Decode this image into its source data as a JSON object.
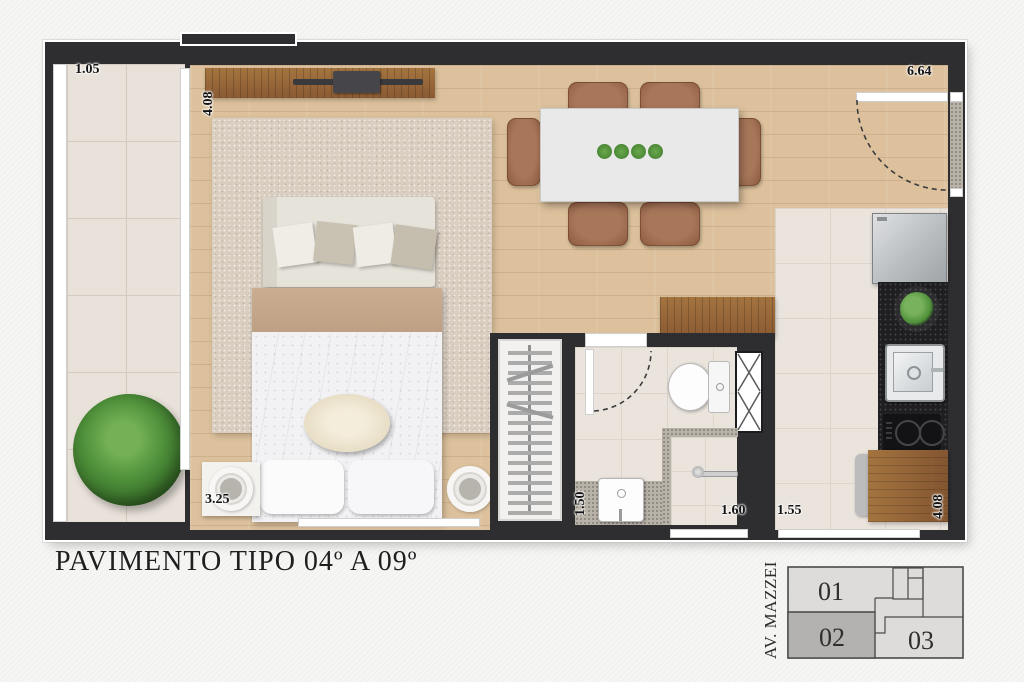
{
  "title": "PAVIMENTO TIPO 04º A 09º",
  "floorplan": {
    "dimensions": {
      "balcony_width": "1.05",
      "bedroom_depth": "4.08",
      "entry_width": "6.64",
      "bedroom_width": "3.25",
      "bathroom_width": "1.50",
      "bathroom_length": "1.60",
      "kitchen_width": "1.55",
      "kitchen_depth": "4.08"
    },
    "colors": {
      "wall": "#2e2d2f",
      "wood_floor": "#dcc19c",
      "tile_floor": "#eae4dd",
      "counter_granite": "#1f1f22",
      "cabinet_wood": "#95653e",
      "upholstery_brown": "#9c6648",
      "plant_green": "#4e8f3a",
      "background": "#f6f6f5",
      "keyplan_highlight": "#b4b2b0"
    }
  },
  "keyplan": {
    "street": "AV. MAZZEI",
    "units": [
      {
        "label": "01",
        "highlighted": false
      },
      {
        "label": "02",
        "highlighted": true
      },
      {
        "label": "03",
        "highlighted": false
      }
    ]
  }
}
